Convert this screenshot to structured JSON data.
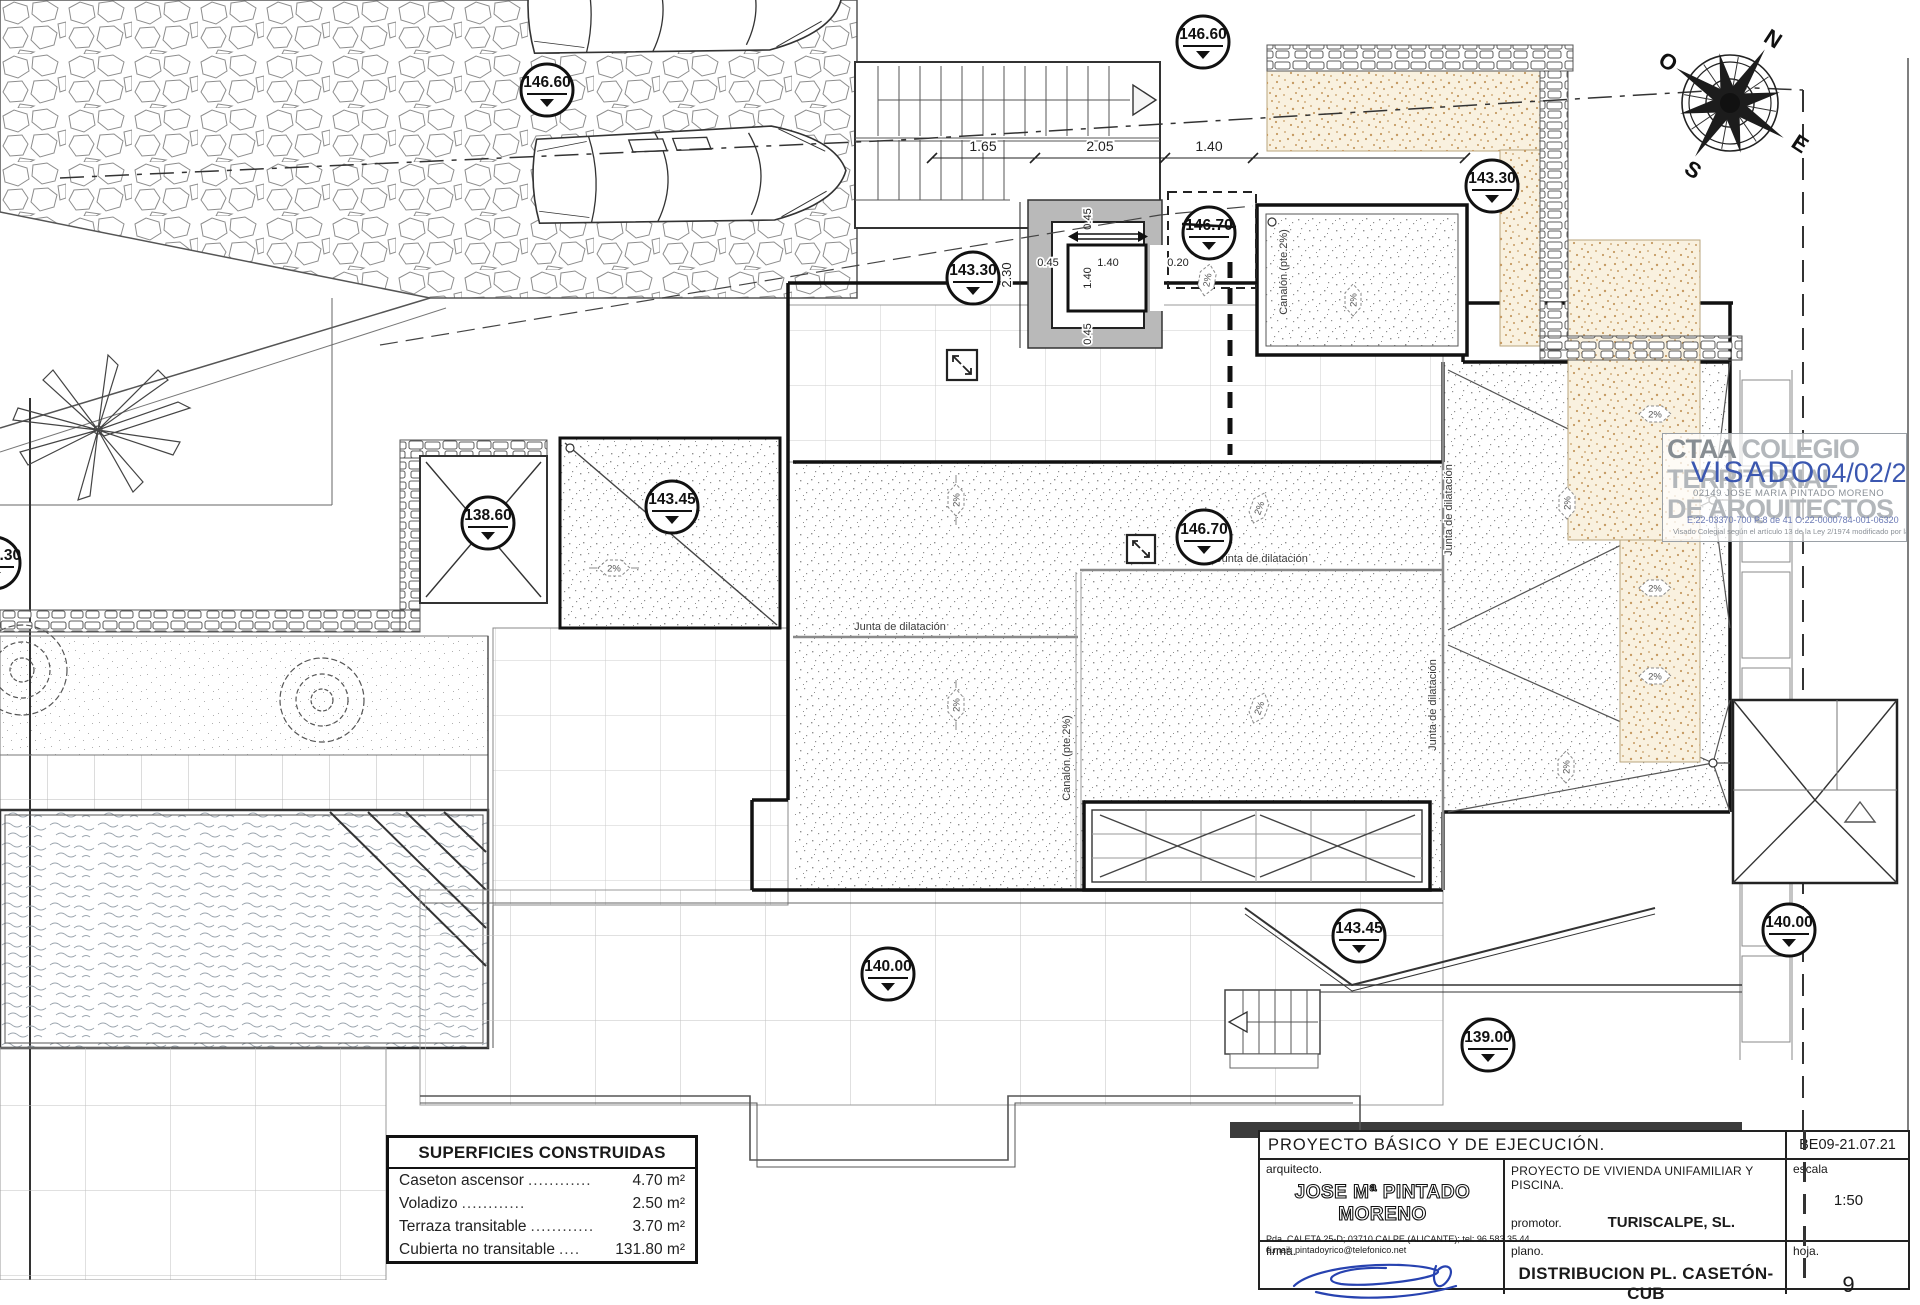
{
  "drawing": {
    "markers": [
      {
        "value": "146.60"
      },
      {
        "value": "146.60"
      },
      {
        "value": "143.30"
      },
      {
        "value": "143.30"
      },
      {
        "value": "146.70"
      },
      {
        "value": "146.70"
      },
      {
        "value": "143.45"
      },
      {
        "value": "138.60"
      },
      {
        "value": "3.30"
      },
      {
        "value": "140.00"
      },
      {
        "value": "143.45"
      },
      {
        "value": "139.00"
      },
      {
        "value": "140.00"
      }
    ],
    "labels": {
      "junta": "Junta de dilatación",
      "canalon": "Canalón (pte.2%)",
      "slope": "2%"
    },
    "dims": {
      "chain": [
        "1.65",
        "2.05",
        "1.40",
        "3.40"
      ],
      "elev_w": [
        "0.45",
        "1.40",
        "0.20"
      ],
      "elev_h": [
        "0.45",
        "1.40",
        "0.45"
      ],
      "core_height": "2.30"
    },
    "compass": {
      "n": "N",
      "o": "O",
      "e": "E",
      "s": "S"
    }
  },
  "areas_table": {
    "title": "SUPERFICIES CONSTRUIDAS",
    "rows": [
      {
        "label": "Caseton ascensor",
        "dots": "............",
        "value": "4.70 m²"
      },
      {
        "label": "Voladizo",
        "dots": "............",
        "value": "2.50 m²"
      },
      {
        "label": "Terraza transitable",
        "dots": "............",
        "value": "3.70 m²"
      },
      {
        "label": "Cubierta no transitable",
        "dots": "....",
        "value": "131.80 m²"
      }
    ]
  },
  "stamp": {
    "org_acronym": "CTAA",
    "org_word1": "COLEGIO",
    "org_word2": "TERRITORIAL",
    "org_word3": "DE ARQUITECTOS",
    "visado": "VISADO",
    "date": "04/02/22",
    "collegiate": "02149 JOSE MARIA PINTADO MORENO",
    "refs": "E:22-03370-700      P:8 de 41      O:22-0000784-001-06320",
    "legal": "Visado Colegial según el artículo 13 de la Ley 2/1974 modificado por la ley 25/2009",
    "accent": "#3b57b0"
  },
  "title_block": {
    "project_type": "PROYECTO  BÁSICO  Y  DE  EJECUCIÓN.",
    "code": "BE09-21.07.21",
    "arquitecto_label": "arquitecto.",
    "architect": "JOSE Mª PINTADO MORENO",
    "address1": "Pda. CALETA 25-D; 03710 CALPE (ALICANTE); tel: 96 583 35 44.",
    "address2": "e.mail: pintadoyrico@telefonico.net",
    "project_title": "PROYECTO  DE  VIVIENDA  UNIFAMILIAR  Y  PISCINA.",
    "promotor_label": "promotor.",
    "promotor": "TURISCALPE, SL.",
    "escala_label": "escala",
    "escala": "1:50",
    "firma_label": "firma.",
    "plano_label": "plano.",
    "plano": "DISTRIBUCION  PL.  CASETÓN-CUB",
    "hoja_label": "hoja.",
    "hoja": "9"
  }
}
